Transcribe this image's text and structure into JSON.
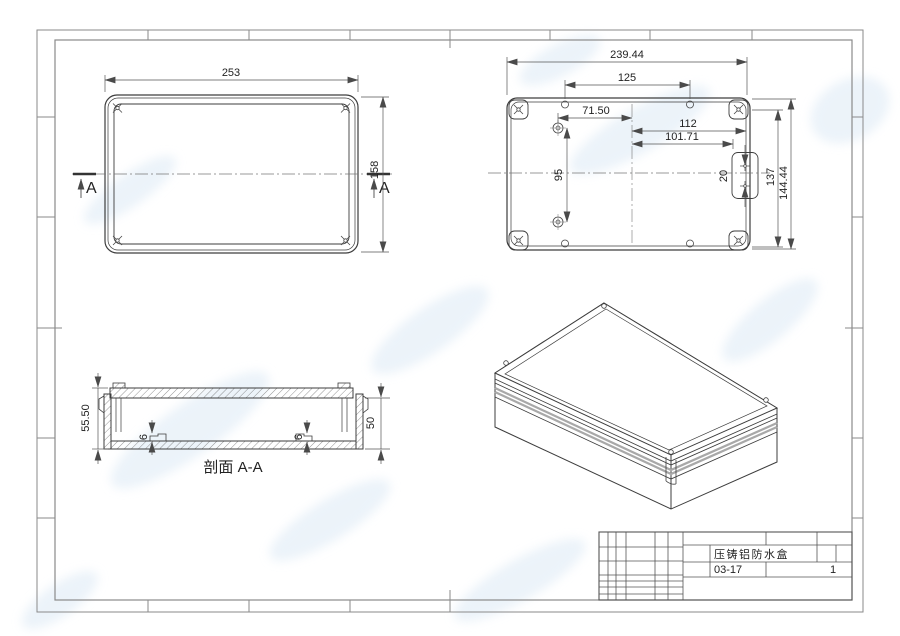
{
  "sheet": {
    "part_name": "压铸铝防水盒",
    "drawing_code": "03-17",
    "sheet_number": "1"
  },
  "top_view": {
    "dim_width": "253",
    "dim_height": "158",
    "section_label": "A"
  },
  "inside_view": {
    "dim_overall_width": "239.44",
    "dim_top_hole_spacing": "125",
    "dim_boss_to_center": "71.50",
    "dim_center_to_wall": "112",
    "dim_center_to_plate": "101.71",
    "dim_boss_spacing": "95",
    "dim_plate_hole_spacing": "20",
    "dim_inner_height": "137",
    "dim_overall_height": "144.44"
  },
  "section_view": {
    "label": "剖面 A-A",
    "dim_overall_height": "55.50",
    "dim_inner_height": "50",
    "dim_boss_height_left": "6",
    "dim_boss_height_right": "6"
  },
  "colors": {
    "object_line": "#3d3d3d",
    "dimension_line": "#555555",
    "frame_line": "#8a8a8a",
    "hatch_line": "#666666",
    "gasket_band": "#a8a8a8",
    "watermark": "#dce9f5"
  }
}
